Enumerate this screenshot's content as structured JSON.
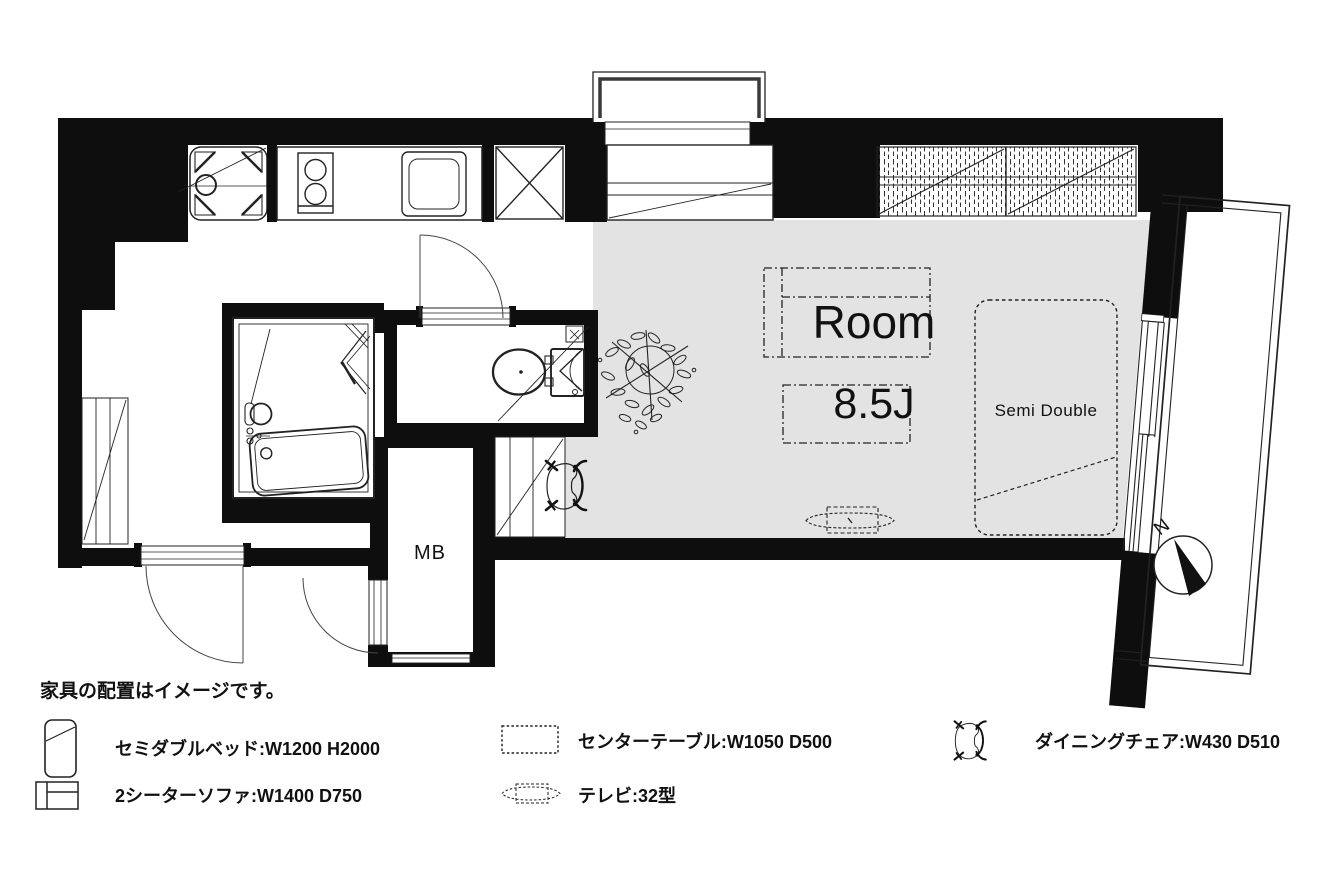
{
  "colors": {
    "wall": "#0e0e0e",
    "floor_gray": "#e3e3e3",
    "line": "#222222",
    "window_frame_dark": "#3a3a3a"
  },
  "room": {
    "label": "Room",
    "size": "8.5J"
  },
  "bed": {
    "label": "Semi Double"
  },
  "meter_box": {
    "label": "MB"
  },
  "compass": {
    "label": "N"
  },
  "disclaimer": "家具の配置はイメージです。",
  "legend": {
    "items": [
      {
        "icon": "bed-icon",
        "label": "セミダブルベッド:W1200 H2000"
      },
      {
        "icon": "sofa-icon",
        "label": "2シーターソファ:W1400 D750"
      },
      {
        "icon": "table-icon",
        "label": "センターテーブル:W1050 D500"
      },
      {
        "icon": "tv-icon",
        "label": "テレビ:32型"
      },
      {
        "icon": "chair-icon",
        "label": "ダイニングチェア:W430 D510"
      }
    ]
  },
  "fixtures": [
    "washing-machine-pan-icon",
    "stove-icon",
    "kitchen-sink-icon",
    "refrigerator-space-icon",
    "bay-window-icon",
    "storage-counter-icon",
    "closet-icon",
    "bathtub-icon",
    "washbasin-icon",
    "folding-door-icon",
    "toilet-icon",
    "corner-basin-icon",
    "entrance-door-icon",
    "toilet-door-icon",
    "meter-box-door-icon",
    "plant-icon",
    "sofa-icon",
    "center-table-icon",
    "tv-icon",
    "bed-icon",
    "dining-chair-icon",
    "balcony-railing-icon",
    "sliding-window-icon",
    "compass-rose-icon"
  ]
}
